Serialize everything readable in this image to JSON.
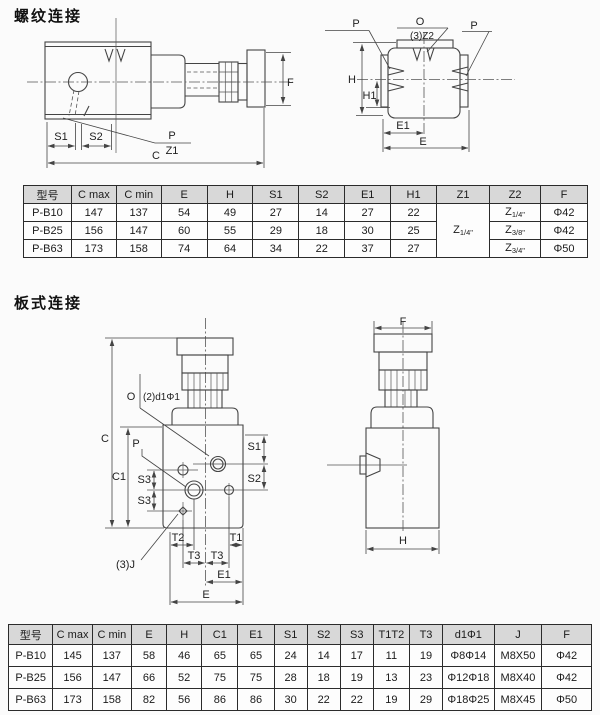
{
  "colors": {
    "line": "#444444",
    "table_border": "#2b2b2b",
    "header_bg": "#d8d8d8",
    "bg": "#fbfbfb"
  },
  "threaded_section": {
    "title": "螺纹连接",
    "side_view_labels": {
      "s1": "S1",
      "s2": "S2",
      "p": "P",
      "z1": "Z1",
      "c": "C",
      "f": "F"
    },
    "front_view_labels": {
      "p_left": "P",
      "o": "O",
      "z2": "(3)Z2",
      "p_right": "P",
      "h": "H",
      "h1": "H1",
      "e1": "E1",
      "e": "E"
    },
    "table": {
      "headers": [
        "型号",
        "C max",
        "C min",
        "E",
        "H",
        "S1",
        "S2",
        "E1",
        "H1",
        "Z1",
        "Z2",
        "F"
      ],
      "rows": [
        [
          "P-B10",
          "147",
          "137",
          "54",
          "49",
          "27",
          "14",
          "27",
          "22",
          {
            "t": "Z",
            "sub": "1/4\"",
            "rowspan": 3
          },
          {
            "t": "Z",
            "sub": "1/4\""
          },
          "Φ42"
        ],
        [
          "P-B25",
          "156",
          "147",
          "60",
          "55",
          "29",
          "18",
          "30",
          "25",
          null,
          {
            "t": "Z",
            "sub": "3/8\""
          },
          "Φ42"
        ],
        [
          "P-B63",
          "173",
          "158",
          "74",
          "64",
          "34",
          "22",
          "37",
          "27",
          null,
          {
            "t": "Z",
            "sub": "3/4\""
          },
          "Φ50"
        ]
      ]
    }
  },
  "plate_section": {
    "title": "板式连接",
    "side_view_labels": {
      "o": "O",
      "d1": "(2)d1Φ1",
      "c": "C",
      "c1": "C1",
      "p": "P",
      "s1": "S1",
      "s2": "S2",
      "s3_upper": "S3",
      "s3_lower": "S3",
      "t2": "T2",
      "t1": "T1",
      "t3_left": "T3",
      "t3_right": "T3",
      "j": "(3)J",
      "e1": "E1",
      "e": "E"
    },
    "front_view_labels": {
      "f": "F",
      "h": "H"
    },
    "table": {
      "headers": [
        "型号",
        "C max",
        "C min",
        "E",
        "H",
        "C1",
        "E1",
        "S1",
        "S2",
        "S3",
        "T1T2",
        "T3",
        "d1Φ1",
        "J",
        "F"
      ],
      "rows": [
        [
          "P-B10",
          "145",
          "137",
          "58",
          "46",
          "65",
          "65",
          "24",
          "14",
          "17",
          "11",
          "19",
          "Φ8Φ14",
          "M8X50",
          "Φ42"
        ],
        [
          "P-B25",
          "156",
          "147",
          "66",
          "52",
          "75",
          "75",
          "28",
          "18",
          "19",
          "13",
          "23",
          "Φ12Φ18",
          "M8X40",
          "Φ42"
        ],
        [
          "P-B63",
          "173",
          "158",
          "82",
          "56",
          "86",
          "86",
          "30",
          "22",
          "22",
          "19",
          "29",
          "Φ18Φ25",
          "M8X45",
          "Φ50"
        ]
      ]
    }
  }
}
